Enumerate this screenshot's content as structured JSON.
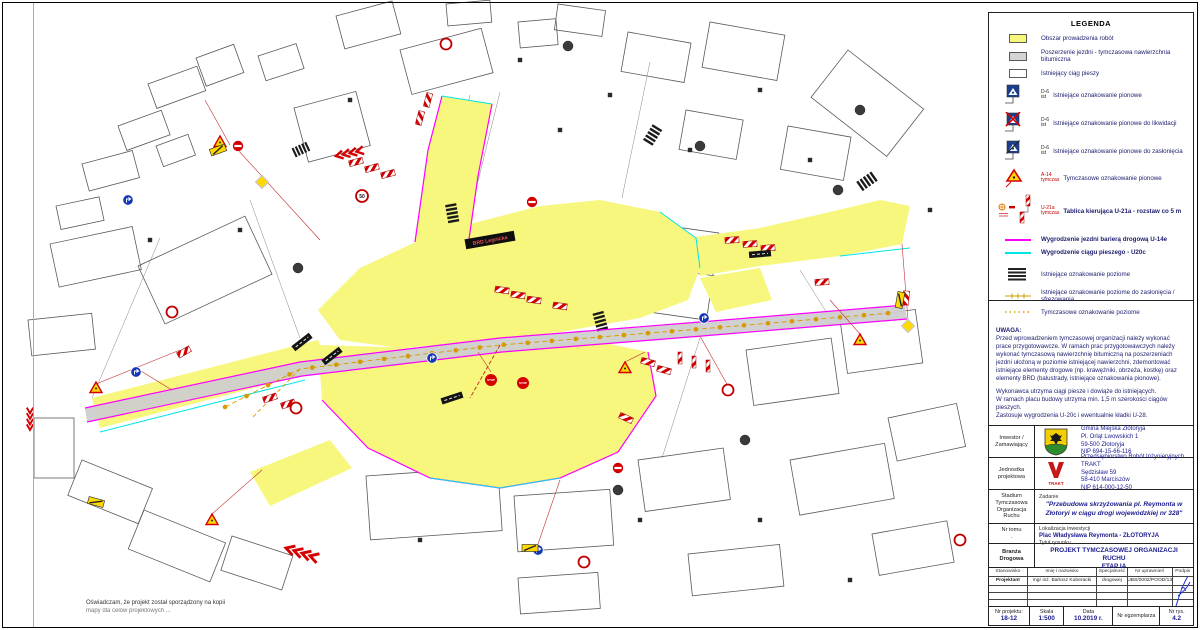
{
  "colors": {
    "work_area": "#F7F77D",
    "widening": "#D4D4D4",
    "barrier_red": "#D40000",
    "road_fence_magenta": "#FF00FF",
    "ped_fence_cyan": "#00E5E5",
    "temp_marking_orange": "#D79A00"
  },
  "sheet": {
    "declaration_line1": "Oświadczam, że projekt został sporządzony na kopii",
    "declaration_line2": "mapy dla celów projektowych ..."
  },
  "map": {
    "labels": {
      "brd_board": "BRD Legnicka",
      "stop": "STOP",
      "speed_limit": "50"
    }
  },
  "legend": {
    "title": "LEGENDA",
    "items": [
      {
        "icon": "work-area-swatch",
        "label": "Obszar prowadzenia robót"
      },
      {
        "icon": "widening-swatch",
        "label": "Poszerzenie jezdni - tymczasowa nawierzchnia bitumiczna"
      },
      {
        "icon": "pedestrian-route-swatch",
        "label": "Istniejący ciąg pieszy"
      },
      {
        "icon": "existing-sign",
        "code": "D-6",
        "sub": "ist",
        "label": "Istniejące oznakowanie pionowe"
      },
      {
        "icon": "sign-to-remove",
        "code": "D-6",
        "sub": "ist",
        "label": "Istniejące oznakowanie pionowe do likwidacji"
      },
      {
        "icon": "sign-to-cover",
        "code": "D-6",
        "sub": "ist",
        "label": "Istniejące oznakowanie pionowe do zasłonięcia"
      },
      {
        "icon": "temporary-sign",
        "code": "A-14",
        "sub": "tymczas",
        "label": "Tymczasowe oznakowanie pionowe"
      },
      {
        "icon": "u21a-board",
        "code": "U-21a",
        "sub": "tymczas",
        "label": "Tablica kierująca U-21a - rozstaw co 5 m"
      },
      {
        "icon": "magenta-line",
        "label": "Wygrodzenie jezdni barierą drogową U-14e"
      },
      {
        "icon": "cyan-line",
        "label": "Wygrodzenie ciągu pieszego - U20c"
      },
      {
        "icon": "existing-marking",
        "label": "Istniejące oznakowanie poziome"
      },
      {
        "icon": "marking-to-cover",
        "label": "Istniejące oznakowanie poziome do zasłonięcia / sfrezowania"
      },
      {
        "icon": "temporary-marking",
        "label": "Tymczasowe oznakowanie poziome"
      }
    ]
  },
  "notes": {
    "heading": "UWAGA:",
    "para1": "Przed wprowadzeniem tymczasowej organizacji należy wykonać prace przygotowawcze. W ramach prac przygotowawczych należy wykonać tymczasową nawierzchnię bitumiczną na poszerzeniach jezdni ułożoną w poziomie istniejącej nawierzchni, zdemontować istniejące elementy drogowe (np. krawężniki, obrzeża, kostkę) oraz elementy BRD (balustrady, istniejące oznakowania pionowe).",
    "line1": "Wykonawca utrzyma ciągi piesze i dowiąże do istniejących.",
    "line2": "W ramach placu budowy utrzyma min. 1,5 m szerokości ciągów pieszych.",
    "line3": "Zastosuje wygrodzenia U-20c i ewentualnie kładki U-28."
  },
  "titleblock": {
    "investor": {
      "label1": "Inwestor /",
      "label2": "Zamawiający",
      "name": "Gmina Miejska Złotoryja",
      "addr1": "Pl. Orląt Lwowskich 1",
      "addr2": "59-500 Złotoryja",
      "nip": "NIP 694-15-66-116"
    },
    "design_unit": {
      "label1": "Jednostka",
      "label2": "projektowa",
      "logo_text": "TRAKT",
      "name": "Przedsiębiorstwo Robót Inżynieryjnych TRAKT",
      "addr1": "Sędzisław 59",
      "addr2": "58-410 Marciszów",
      "nip": "NIP 614-000-12-50"
    },
    "stage": {
      "label": "Stadium",
      "line1": "Tymczasowa",
      "line2": "Organizacja",
      "line3": "Ruchu",
      "task_label": "Zadanie",
      "task": "\"Przebudowa skrzyżowania pl. Reymonta w Złotoryi w ciągu drogi wojewódzkiej nr 328\""
    },
    "volume": {
      "label": "Nr tomu",
      "value": ".",
      "loc_label": "Lokalizacja inwestycji",
      "loc_value": "Plac Władysława Reymonta - ZŁOTORYJA"
    },
    "branch": {
      "label": "Branża",
      "value": "Drogowa",
      "title_label": "Tytuł rysunku",
      "title1": "PROJEKT TYMCZASOWEJ ORGANIZACJI RUCHU",
      "title2": "ETAP IA"
    },
    "personnel": {
      "headers": [
        "Stanowisko",
        "Imię i nazwisko",
        "Specjalność",
        "Nr uprawnień",
        "Podpis"
      ],
      "row": {
        "role": "Projektant",
        "name": "mgr inż. Bartosz Kuberacki",
        "specialty": "drogowej",
        "license": "UBS/0002/POOD/13"
      }
    },
    "footer": {
      "no_label": "Nr projektu:",
      "no": "18-12",
      "scale_label": "Skala",
      "scale": "1:500",
      "date_label": "Data",
      "date": "10.2019 r.",
      "copy_label": "Nr egzemplarza",
      "fig_label": "Nr rys.",
      "fig": "4.2"
    }
  }
}
